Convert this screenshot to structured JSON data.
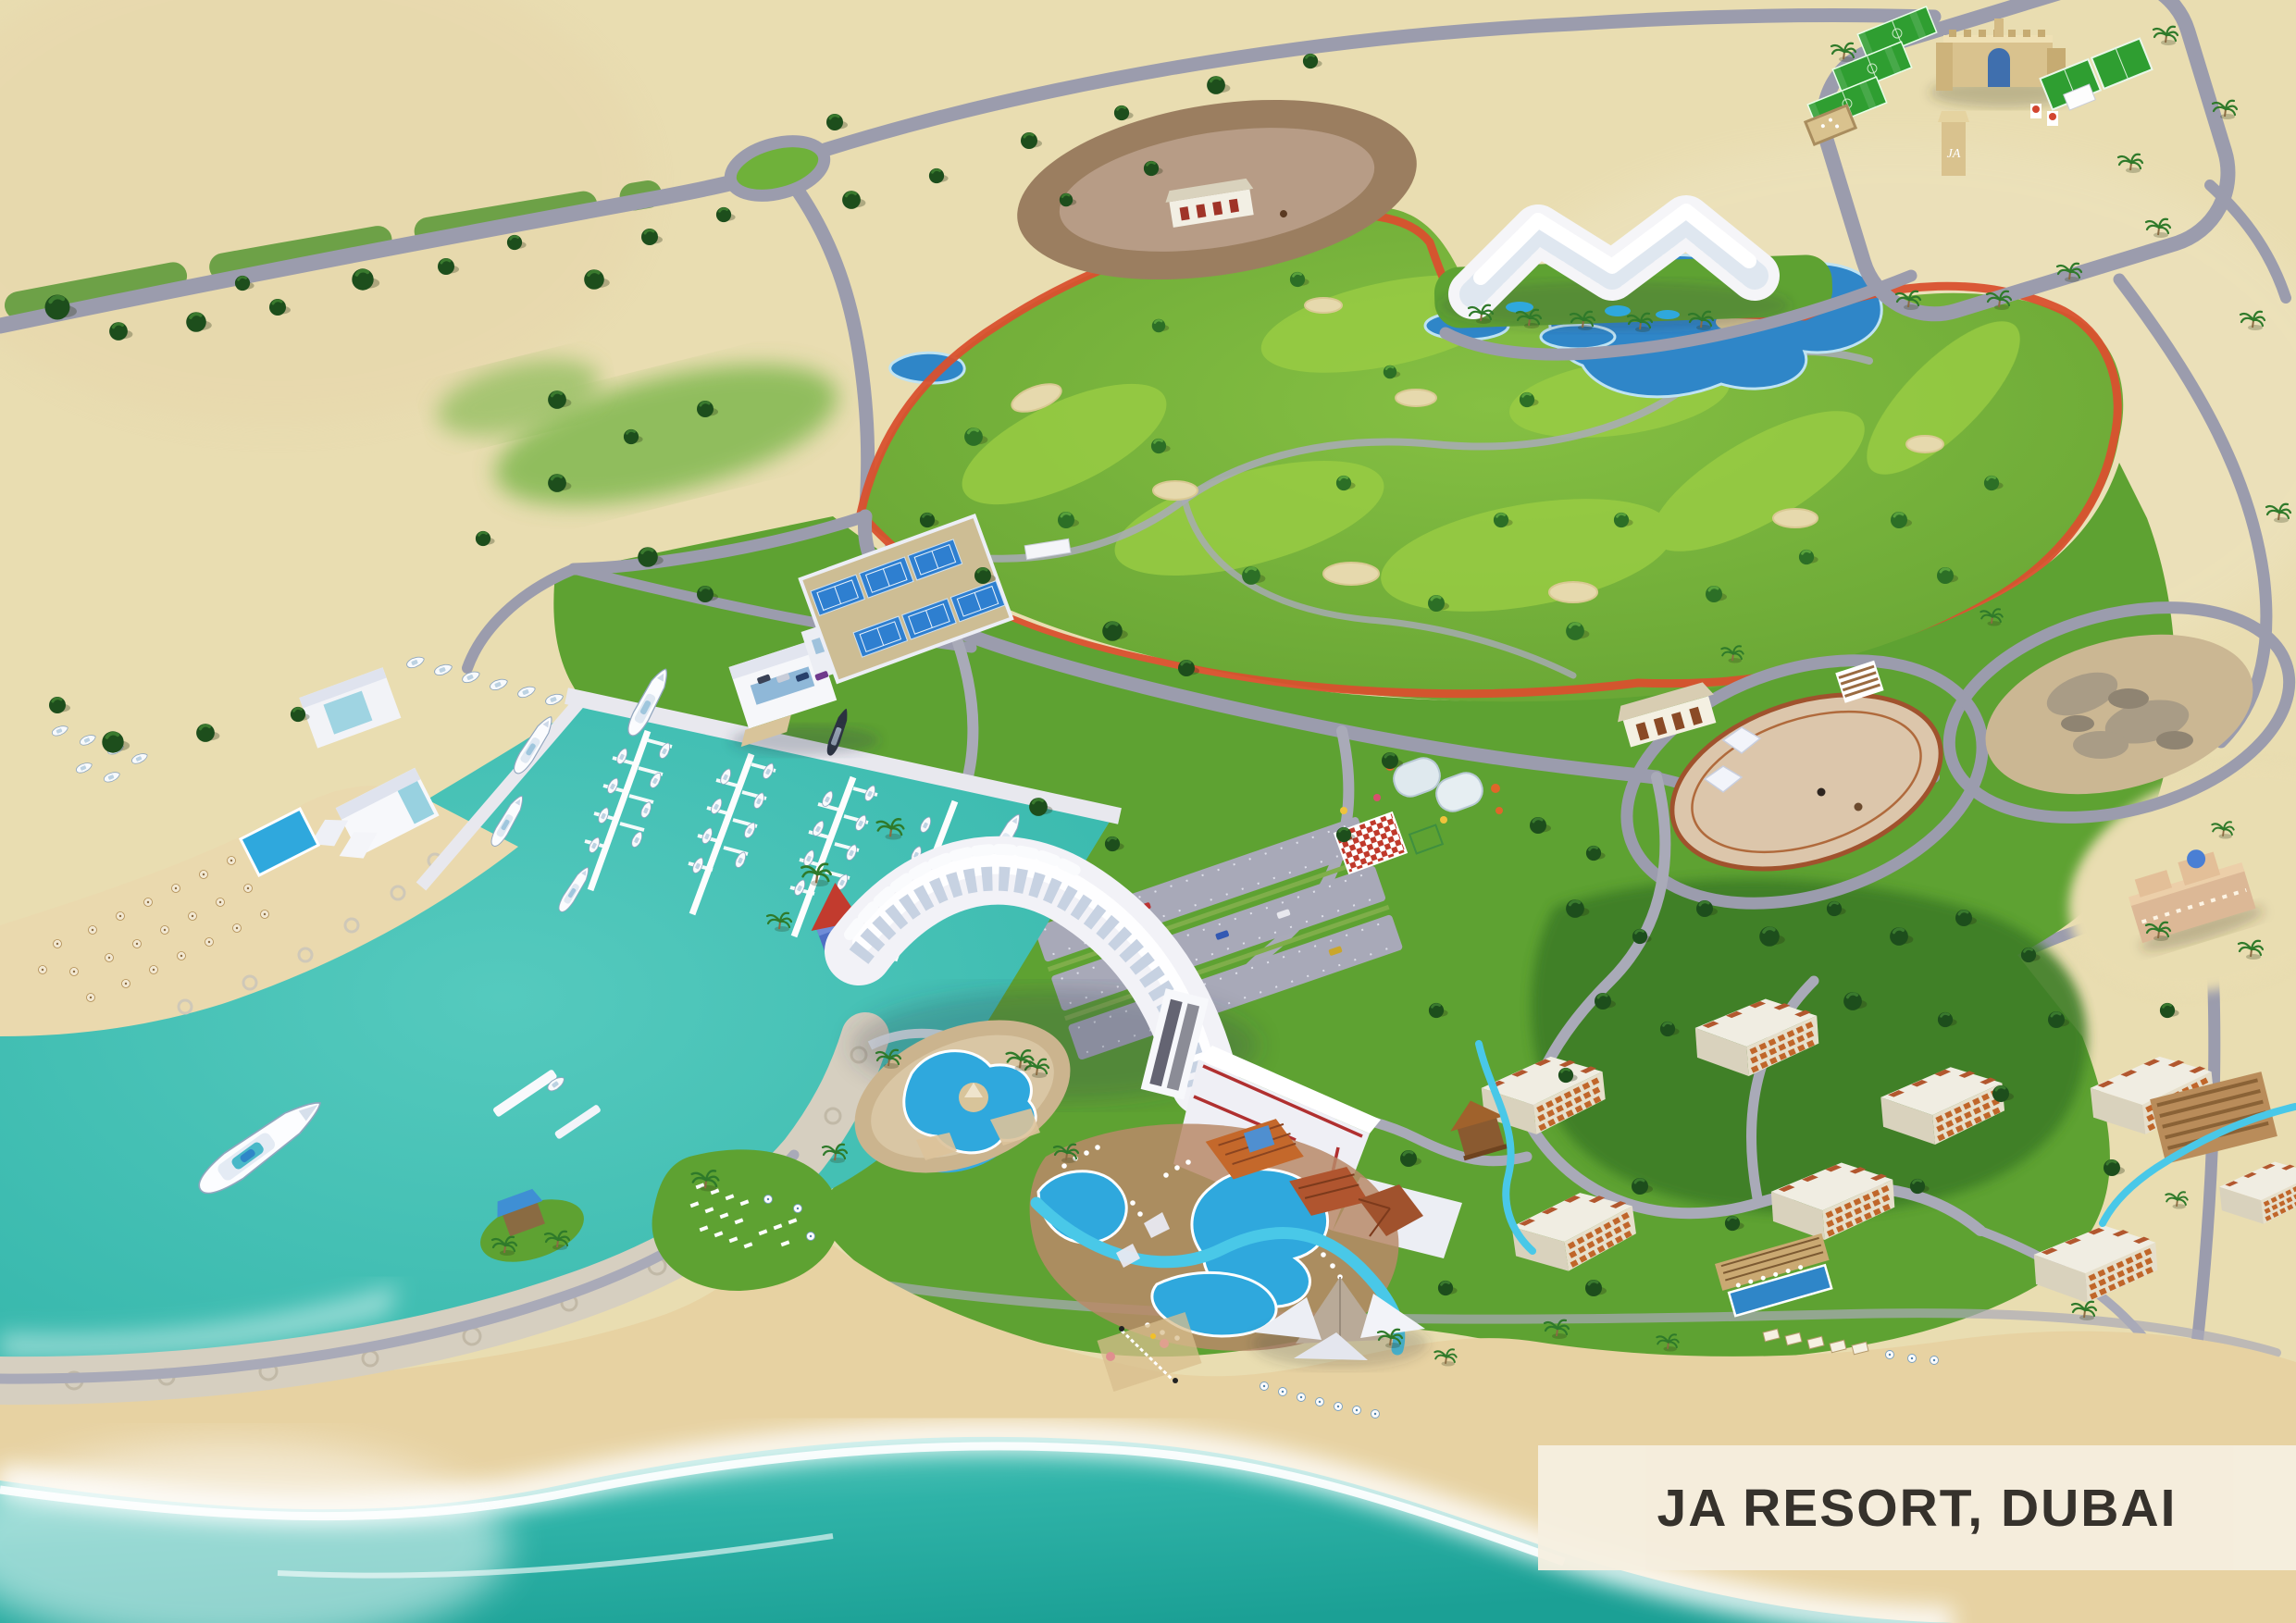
{
  "map": {
    "title_label": "JA RESORT, DUBAI",
    "tower_monogram": "JA"
  },
  "colors": {
    "sand": "#e9ddb1",
    "beach": "#e7d2a2",
    "sea": "#2fb3a8",
    "seaDeep": "#1ba095",
    "lagoon": "#41c0b5",
    "foam": "#ffffff",
    "grass": "#5ea232",
    "grassLight": "#8ec73f",
    "golf": "#6fb13a",
    "treeDark": "#1d4e1c",
    "treeMid": "#2c6f26",
    "road": "#9b9cad",
    "path": "#a9aab8",
    "track": "#d9502e",
    "lake": "#2f86c8",
    "pool": "#2fa8dd",
    "river": "#49c8e8",
    "building": "#f5f5f8",
    "buildingShadow": "#d9dae6",
    "windowBlue": "#a9c3d9",
    "roofOrange": "#c4682b",
    "roofTerracotta": "#b0552f",
    "fortTan": "#d9c28e",
    "rockBeige": "#cbb793",
    "breakwater": "#d6cfc0",
    "ovalRing": "#9b7e60",
    "ovalInner": "#b79c86",
    "labelBg": "#f6efe0",
    "labelText": "#2d2a26"
  }
}
